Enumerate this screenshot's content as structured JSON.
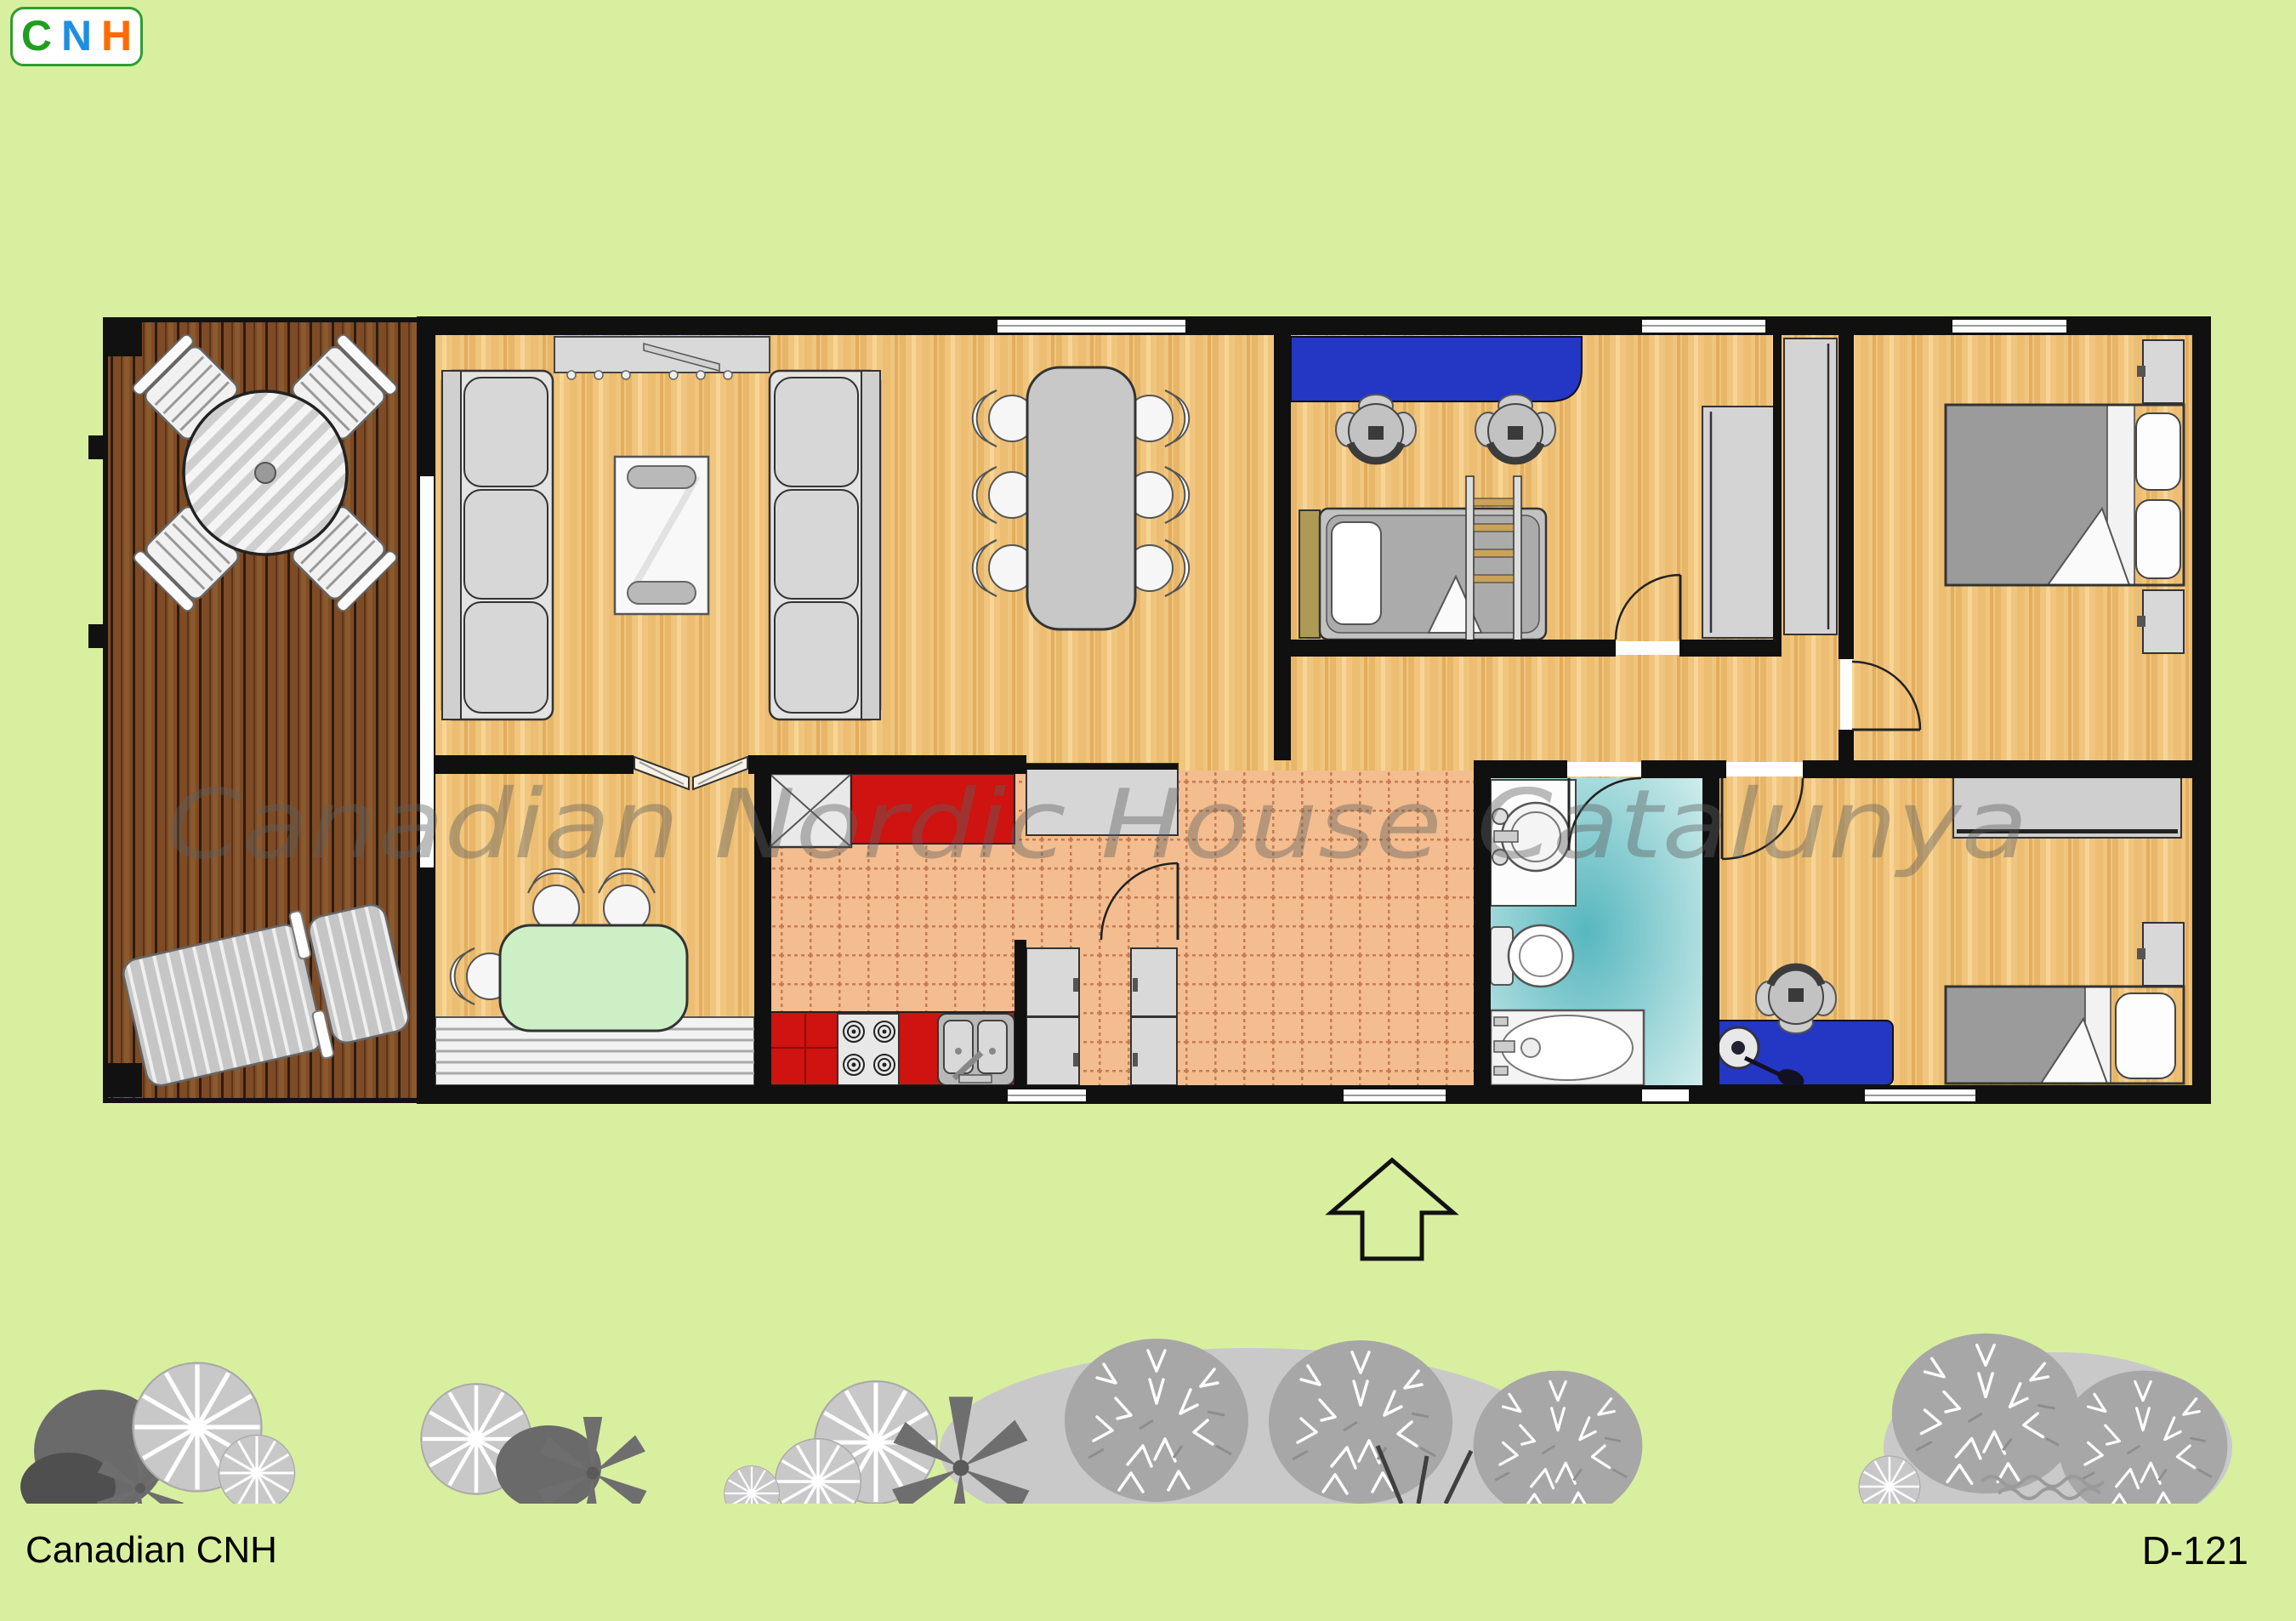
{
  "header": {
    "logo_letters": [
      {
        "text": "C",
        "color": "#1f9e1f"
      },
      {
        "text": "N",
        "color": "#1e8fe0"
      },
      {
        "text": "H",
        "color": "#ff6a00"
      }
    ]
  },
  "watermark": {
    "text": "Canadian Nordic House Catalunya"
  },
  "footer": {
    "company": "Canadian CNH",
    "plan_code": "D-121"
  },
  "compass": {
    "type": "entrance-arrow",
    "direction": "up"
  },
  "colors": {
    "background": "#d9efa0",
    "wall": "#101010",
    "wood_floor": "#f0c57e",
    "deck_wood": "#7d4b26",
    "kitchen_tile": "#f3bd90",
    "kitchen_red": "#ce1310",
    "desk_blue": "#2436c4",
    "nook_table_green": "#cdefc5",
    "bathroom_teal": "#57b7bf",
    "furniture_gray": "#d6d6d6",
    "tree_gray": "#b5b5b5",
    "watermark_gray": "rgba(96,96,96,0.42)"
  },
  "plan": {
    "rooms": [
      {
        "name": "terrace-deck",
        "items": [
          "round-patio-table",
          "patio-chair-x4",
          "sun-lounger"
        ]
      },
      {
        "name": "living-room",
        "items": [
          "sofa-x2",
          "coffee-table",
          "sideboard"
        ]
      },
      {
        "name": "dining-area",
        "items": [
          "dining-table",
          "chair-x6"
        ]
      },
      {
        "name": "office-bedroom",
        "items": [
          "blue-desk",
          "office-chair-x2",
          "single-bed",
          "ladder",
          "closet-x2"
        ]
      },
      {
        "name": "hallway",
        "items": [
          "built-in-closet"
        ]
      },
      {
        "name": "master-bedroom",
        "items": [
          "double-bed",
          "nightstand-x2"
        ]
      },
      {
        "name": "bathroom",
        "items": [
          "washbasin",
          "toilet",
          "bathtub"
        ]
      },
      {
        "name": "bedroom-2",
        "items": [
          "single-bed",
          "sliding-wardrobe",
          "blue-desk",
          "desk-lamp",
          "office-chair",
          "nightstand"
        ]
      },
      {
        "name": "kitchen",
        "items": [
          "tall-cabinet",
          "red-cabinets",
          "stove",
          "double-sink",
          "fridge-freezer",
          "cabinet"
        ]
      },
      {
        "name": "breakfast-nook",
        "items": [
          "green-table",
          "chair-x3",
          "step-bench",
          "double-doors"
        ]
      }
    ]
  }
}
